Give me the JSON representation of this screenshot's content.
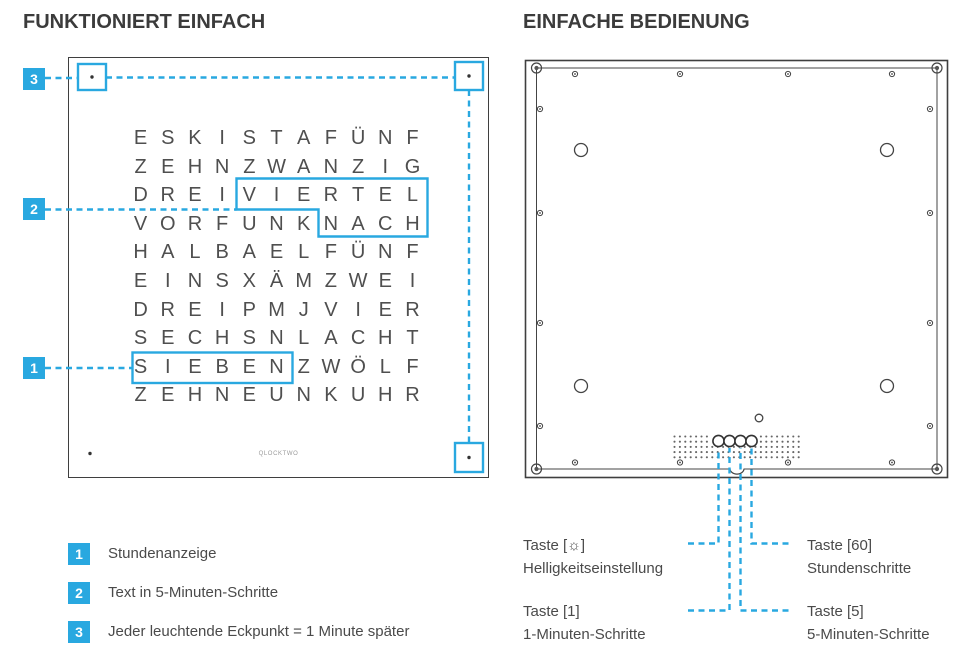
{
  "left": {
    "title": "FUNKTIONIERT EINFACH",
    "clock": {
      "grid_rows": [
        "ESKISTAFÜNF",
        "ZEHNZWANZIG",
        "DREIVIERTEL",
        "VORFUNKNACH",
        "HALBAELFÜNF",
        "EINSXÄMZWEI",
        "DREIPMJVIER",
        "SECHSNLACHT",
        "SIEBENZWÖLF",
        "ZEHNEUNKUHR"
      ],
      "highlighted_words": [
        "VIERTEL",
        "NACH",
        "SIEBEN"
      ],
      "brand": "QLOCKTWO"
    },
    "legend": {
      "items": [
        {
          "num": "1",
          "text": "Stundenanzeige"
        },
        {
          "num": "2",
          "text": "Text in 5-Minuten-Schritte"
        },
        {
          "num": "3",
          "text": "Jeder leuchtende Eckpunkt = 1 Minute später"
        }
      ]
    }
  },
  "right": {
    "title": "EINFACHE BEDIENUNG",
    "buttons": [
      {
        "label": "Taste [☼]",
        "desc": "Helligkeitseinstellung"
      },
      {
        "label": "Taste [60]",
        "desc": "Stundenschritte"
      },
      {
        "label": "Taste [1]",
        "desc": "1-Minuten-Schritte"
      },
      {
        "label": "Taste [5]",
        "desc": "5-Minuten-Schritte"
      }
    ]
  },
  "colors": {
    "accent": "#29a8e0",
    "ink": "#3f3f3f",
    "letters": "#4f4f4f"
  }
}
